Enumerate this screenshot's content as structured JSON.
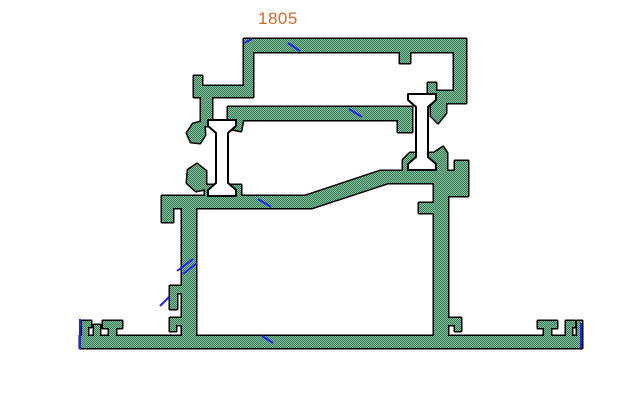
{
  "drawing": {
    "label": "1805",
    "colors": {
      "label": "#cf6b33",
      "outline": "#000000",
      "hatch_dark": "#2f7e58",
      "hatch_light": "#8cba9b",
      "thermal_break_fill": "#ffffff",
      "annotation": "#2222ee",
      "background": "#ffffff"
    }
  }
}
